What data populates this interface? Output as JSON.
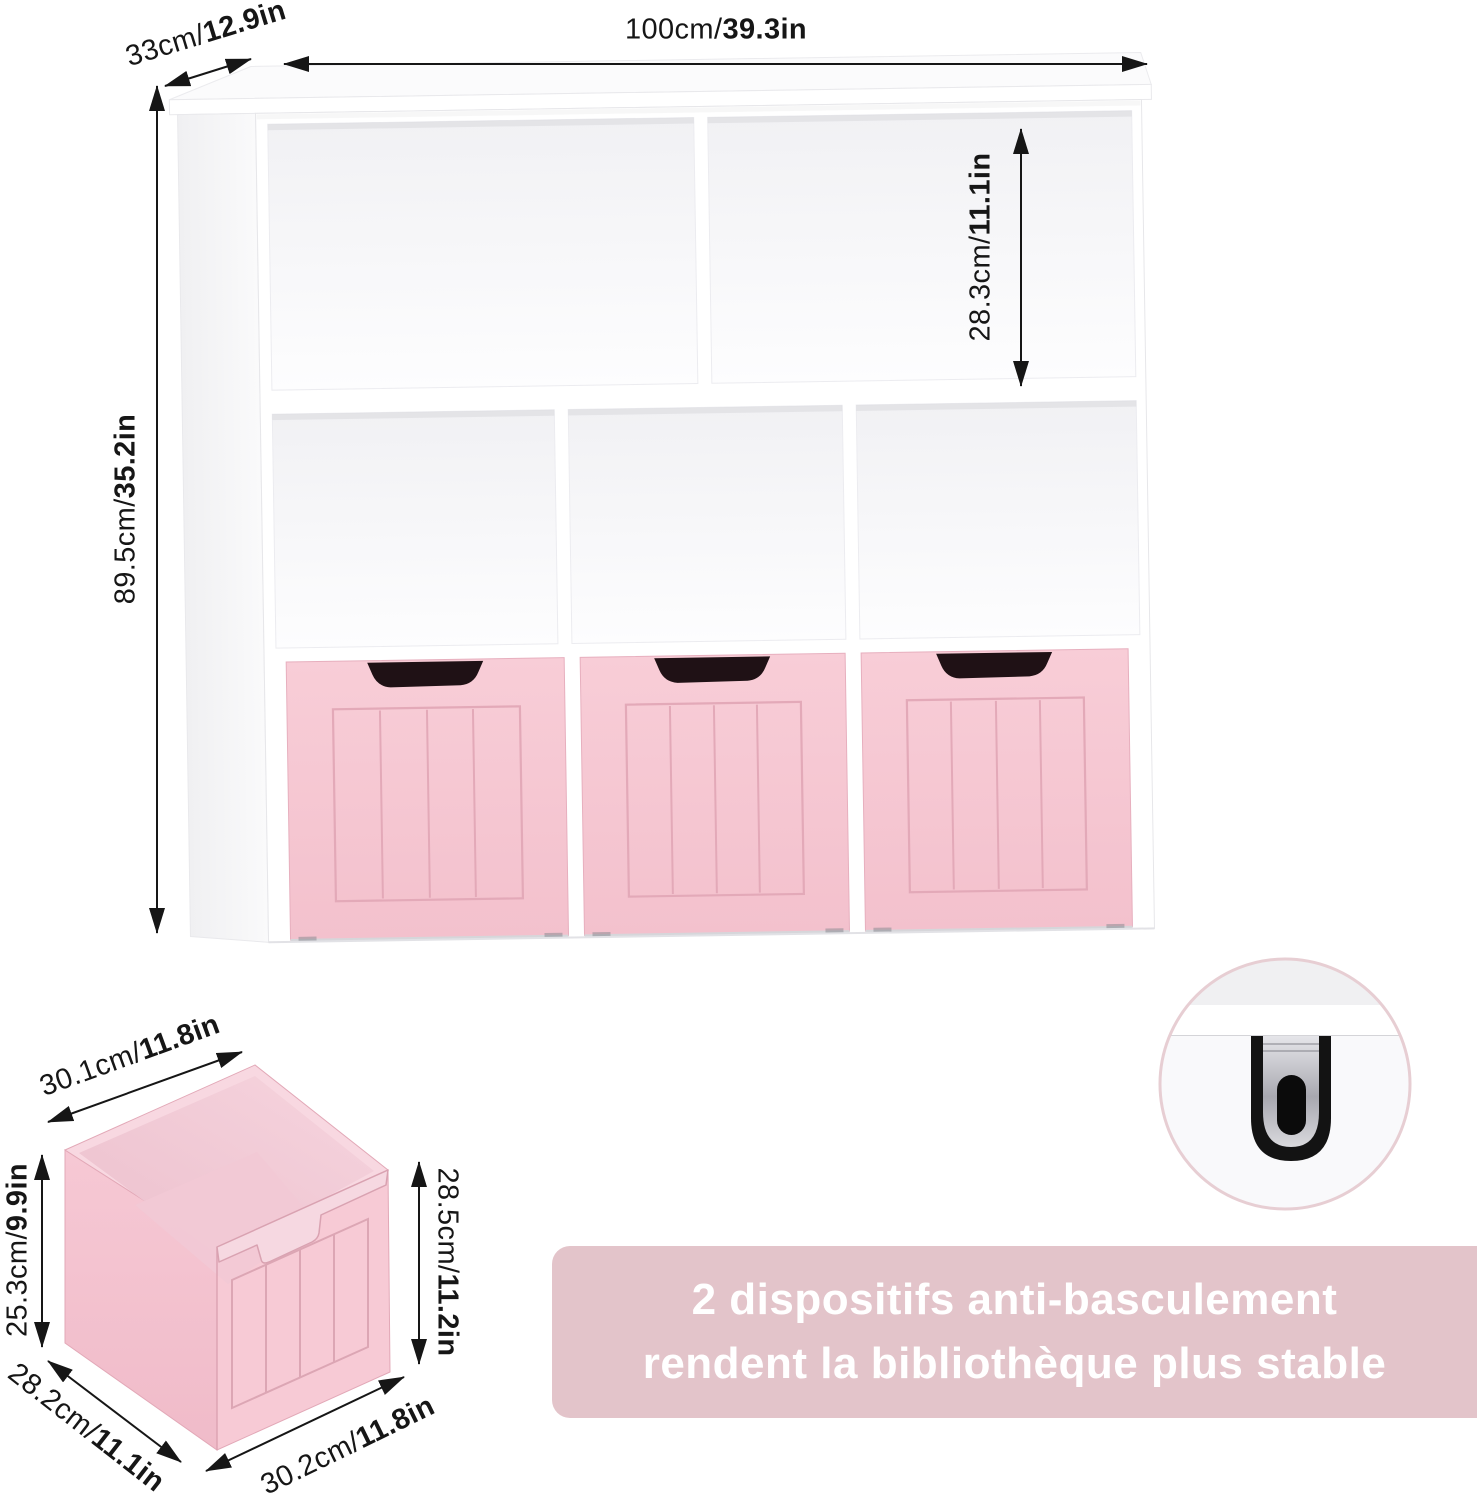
{
  "labels": {
    "depth": {
      "metric": "33cm/",
      "imperial": "12.9in"
    },
    "width": {
      "metric": "100cm/",
      "imperial": "39.3in"
    },
    "height": {
      "metric": "89.5cm/",
      "imperial": "35.2in"
    },
    "cubby_height": {
      "metric": "28.3cm/",
      "imperial": "11.1in"
    }
  },
  "drawer_labels": {
    "top_width": {
      "metric": "30.1cm/",
      "imperial": "11.8in"
    },
    "side_height": {
      "metric": "25.3cm/",
      "imperial": "9.9in"
    },
    "depth": {
      "metric": "28.2cm/",
      "imperial": "11.1in"
    },
    "front_width": {
      "metric": "30.2cm/",
      "imperial": "11.8in"
    },
    "front_height": {
      "metric": "28.5cm/",
      "imperial": "11.2in"
    }
  },
  "banner": {
    "line1": "2 dispositifs anti-basculement",
    "line2": "rendent la bibliothèque plus stable"
  },
  "colors": {
    "drawer_pink": "#f6c8d3",
    "drawer_line_pink": "#e3a9b8",
    "banner_pink": "#e3c4ca",
    "notch_dark": "#1f1115",
    "rim_pink": "#f8d8e1",
    "metal_gray": "#b9b9bf",
    "arrow_black": "#161616"
  }
}
